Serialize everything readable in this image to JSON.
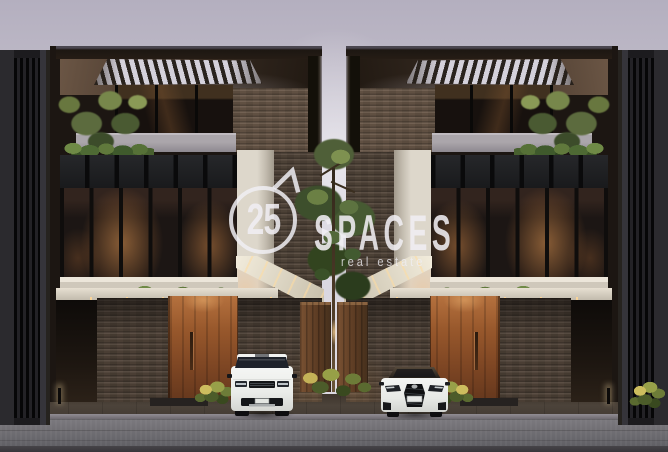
{
  "watermark": {
    "number": "25",
    "brand": "SPACES",
    "tagline": "real estate",
    "color": "#f0eef3"
  },
  "scene": {
    "objects": [
      "left-modern-townhouse",
      "right-modern-townhouse",
      "central-tree-with-planters",
      "white-suv-range-rover-style",
      "white-sedan-lexus-style",
      "street-and-curb",
      "overcast-lavender-sky"
    ],
    "palette": {
      "sky_top": "#b4afbf",
      "sky_bottom": "#dfdce4",
      "canopy_wood": "#4a3a2e",
      "stone_wall": "#6b594a",
      "stone_dark": "#52453a",
      "door_wood": "#98582c",
      "window_glow": "#c98252",
      "vine_green": "#4e6a34",
      "balcony_white": "#cfc8bb",
      "street_gray": "#706e73",
      "car_white": "#f0f1ef"
    }
  }
}
